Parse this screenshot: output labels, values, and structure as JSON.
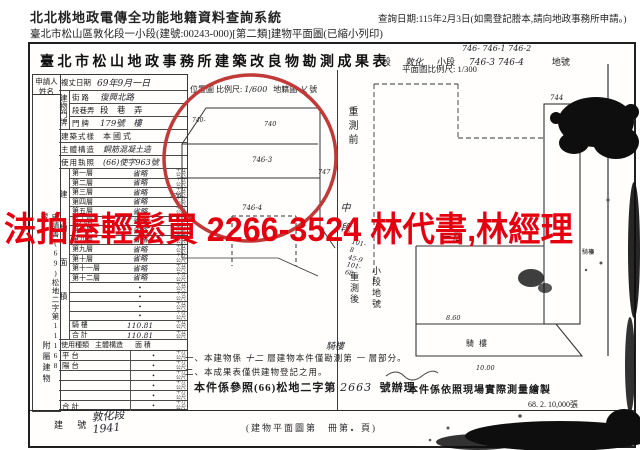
{
  "header": {
    "system_title": "北北桃地政電傳全功能地籍資料查詢系統",
    "query_date": "查詢日期:115年2月3日(如需登記謄本,請向地政事務所申請。)",
    "doc_line": "臺北市松山區敦化段一小段(建號:00243-000)[第二類]建物平面圖(已縮小列印)"
  },
  "watermark": {
    "text": "法拍屋輕鬆買 2266-3524 林代書,林經理",
    "color": "#e50010"
  },
  "annotation": {
    "ellipse_color": "#c03a38"
  },
  "form": {
    "title": "臺北市松山地政事務所建築改良物勘測成果表",
    "seg_line": {
      "lots_top": "746-  746-1  746-2",
      "seg": "段",
      "seg_value": "敦化",
      "small_seg": "小段",
      "small_lots": "746-3  746-4",
      "lot_label": "地號"
    },
    "locmap": {
      "label": "位置圖 比例尺:",
      "scale": "1/600",
      "cad": "地籍圖",
      "cad_no": "乂",
      "no_label": "號"
    },
    "applicant": "申請人姓名",
    "survey_label": "複丈日期",
    "survey_value": "69年9月一日",
    "app_no": "申請書(69)松地二字第11168號",
    "door_group": "建物門牌",
    "door_rows": [
      {
        "label": "街 路",
        "value": "復興北路"
      },
      {
        "label": "段巷弄",
        "value": "段　巷　弄"
      },
      {
        "label": "門 牌",
        "value": "179號　樓"
      }
    ],
    "style_label": "建築式樣",
    "style_value": "本 國 式",
    "structure_label": "主體構造",
    "structure_value": "鋼筋混凝土造",
    "license_label": "使用執照",
    "license_value": "(66)使字963號",
    "area_group": "建物面積",
    "unit": "平方公尺",
    "area_rows": [
      {
        "label": "第一層",
        "value": "省略"
      },
      {
        "label": "第二層",
        "value": "省略"
      },
      {
        "label": "第三層",
        "value": "省略"
      },
      {
        "label": "第四層",
        "value": "省略"
      },
      {
        "label": "第五層",
        "value": "省略"
      },
      {
        "label": "第六層",
        "value": "省略"
      },
      {
        "label": "第七層",
        "value": "省略"
      },
      {
        "label": "第八層",
        "value": "省略"
      },
      {
        "label": "第九層",
        "value": "省略"
      },
      {
        "label": "第十層",
        "value": "省略"
      },
      {
        "label": "第十一層",
        "value": "省略"
      },
      {
        "label": "第十二層",
        "value": "省略"
      },
      {
        "label": "",
        "value": "•"
      },
      {
        "label": "",
        "value": "•"
      },
      {
        "label": "",
        "value": "•"
      },
      {
        "label": "",
        "value": "•"
      },
      {
        "label": "騎 樓",
        "value": "110.81"
      },
      {
        "label": "合 計",
        "value": "110.81"
      }
    ],
    "annex_group": "附屬建物",
    "annex_headers": [
      "使用種類",
      "主體構造",
      "面 積"
    ],
    "annex_rows": [
      {
        "label": "平 台",
        "value": "•"
      },
      {
        "label": "陽 台",
        "value": "•"
      },
      {
        "label": "",
        "value": "•"
      },
      {
        "label": "",
        "value": "•"
      },
      {
        "label": "",
        "value": "•"
      },
      {
        "label": "合 計",
        "value": "•"
      }
    ],
    "building_no_label": "建 號",
    "building_no_value": "敦化段 1941"
  },
  "plan": {
    "scale_label": "平面圖比例尺: 1/300",
    "before": "重測前",
    "mid": "中段",
    "old_lots": "101-8 45-9 101-68",
    "after": "重測後",
    "after2": "小段地號",
    "floor": "一層",
    "arcade": "騎樓",
    "arcade2": "騎樓",
    "dim1": "8.60",
    "dim2": "10.00",
    "blk": "744"
  },
  "map": {
    "lots": {
      "l1": "740-",
      "l2": "740",
      "l3": "746-3",
      "l4": "747",
      "l5": "746-4",
      "l6": "776"
    }
  },
  "notes": {
    "n1_pre": "一、本建物係",
    "n1_hand1": "十二",
    "n1_mid": "層建物本件僅勘測第",
    "n1_hand2": "一",
    "n1_suf": "層部分。",
    "n1_top": "騎樓",
    "n2": "二、本成果表僅供建物登記之用。",
    "n3_pre": "本件係參照(66)松地二字第",
    "n3_hand": "2663",
    "n3_suf": "號辦理",
    "n4": "本件係依照現場實際測量繪製",
    "print_info": "68. 2. 10,000張",
    "page_ref": "(建物平面圖第　冊第　頁)"
  }
}
